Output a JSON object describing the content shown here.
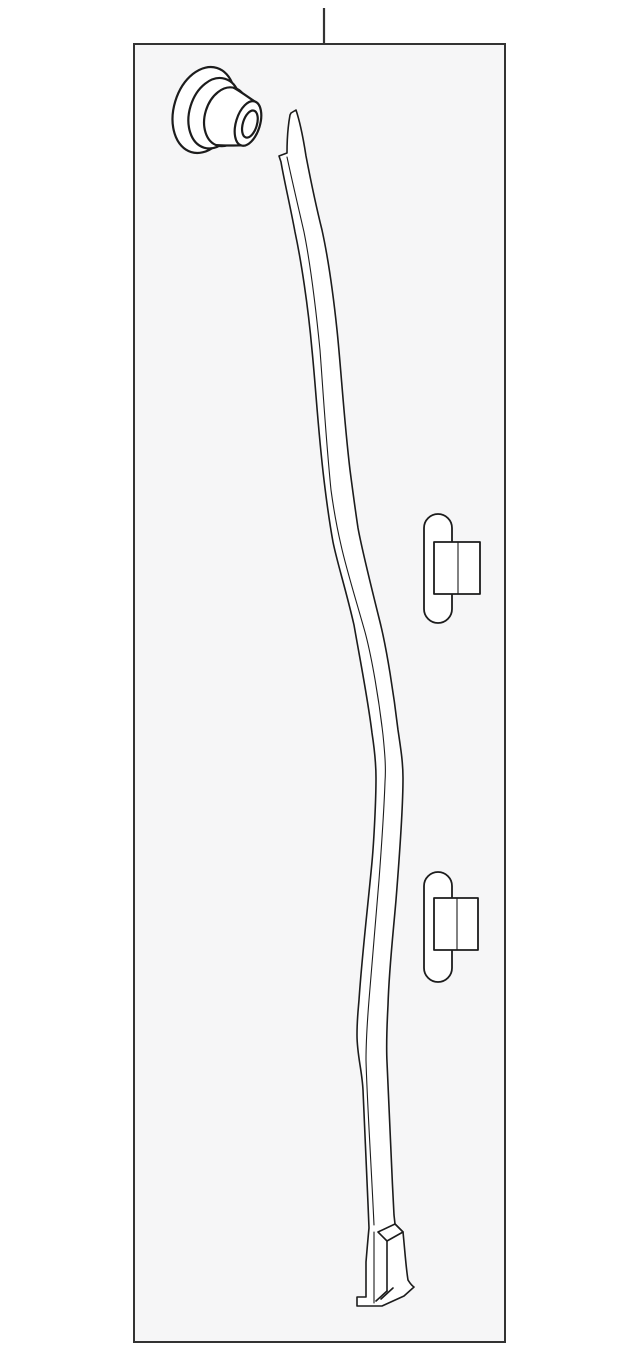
{
  "canvas": {
    "width": 640,
    "height": 1354,
    "background": "#ffffff"
  },
  "frame": {
    "x": 134,
    "y": 44,
    "width": 371,
    "height": 1298,
    "fill": "#f6f6f7",
    "stroke": "#333333",
    "stroke_width": 2
  },
  "leader": {
    "x1": 324,
    "y1": 8,
    "x2": 324,
    "y2": 44,
    "stroke": "#333333",
    "stroke_width": 2.2
  },
  "art": {
    "line_color": "#1c1c1c",
    "part_fill": "#ffffff",
    "outline_width": 1.6,
    "thin_width": 1.1,
    "grommet_width": 2.2,
    "clip_width": 1.8
  },
  "parts": [
    {
      "id": "grommet",
      "name": "grommet-fastener"
    },
    {
      "id": "strip",
      "name": "retainer-strip"
    },
    {
      "id": "clip-upper",
      "name": "retaining-clip-upper"
    },
    {
      "id": "clip-lower",
      "name": "retaining-clip-lower"
    }
  ]
}
